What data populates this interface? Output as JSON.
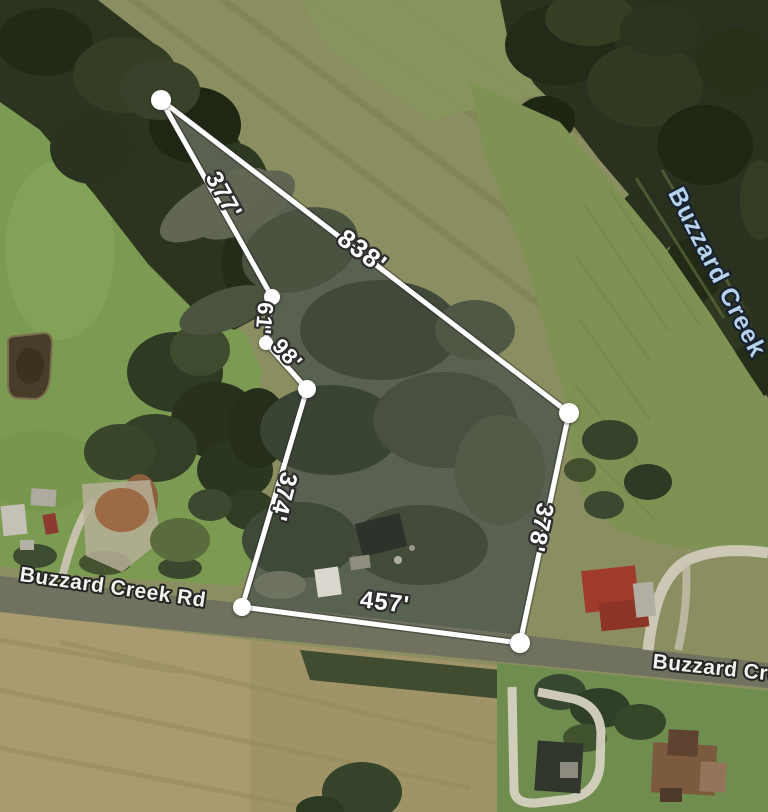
{
  "map": {
    "type": "aerial-parcel-measurement-view",
    "measurement": {
      "unit": "feet",
      "vertices": [
        {
          "x": 161,
          "y": 100,
          "r": 10
        },
        {
          "x": 272,
          "y": 297,
          "r": 8
        },
        {
          "x": 266,
          "y": 343,
          "r": 7
        },
        {
          "x": 307,
          "y": 389,
          "r": 9
        },
        {
          "x": 242,
          "y": 607,
          "r": 9
        },
        {
          "x": 520,
          "y": 643,
          "r": 10
        },
        {
          "x": 569,
          "y": 413,
          "r": 10
        }
      ],
      "edge_labels": [
        {
          "text": "377'",
          "x": 217,
          "y": 199,
          "angle": 61,
          "size": 24
        },
        {
          "text": "61'",
          "x": 257,
          "y": 318,
          "angle": 95,
          "size": 22
        },
        {
          "text": "98'",
          "x": 282,
          "y": 359,
          "angle": 48,
          "size": 22
        },
        {
          "text": "374'",
          "x": 276,
          "y": 495,
          "angle": 104,
          "size": 24
        },
        {
          "text": "457'",
          "x": 384,
          "y": 610,
          "angle": 7,
          "size": 24
        },
        {
          "text": "378'",
          "x": 533,
          "y": 526,
          "angle": 102,
          "size": 24
        },
        {
          "text": "838'",
          "x": 357,
          "y": 258,
          "angle": 37,
          "size": 26
        }
      ]
    },
    "place_labels": [
      {
        "text": "Buzzard Creek Rd",
        "kind": "road",
        "x": 112,
        "y": 594,
        "angle": 8,
        "size": 21,
        "anchor": "middle"
      },
      {
        "text": "Buzzard Cre",
        "kind": "road",
        "x": 652,
        "y": 668,
        "angle": 6,
        "size": 21,
        "anchor": "start"
      },
      {
        "text": "Buzzard Creek",
        "kind": "creek",
        "x": 710,
        "y": 276,
        "angle": 63,
        "size": 25,
        "anchor": "middle"
      }
    ],
    "colors": {
      "measurement_line": "#ffffff",
      "measurement_text": "#ffffff",
      "measurement_halo": "#2e2e2e",
      "parcel_boundary_yellow": "#e4e62c",
      "road_label_text": "#f2f2ef",
      "creek_label_text": "#b7d3ec"
    }
  }
}
